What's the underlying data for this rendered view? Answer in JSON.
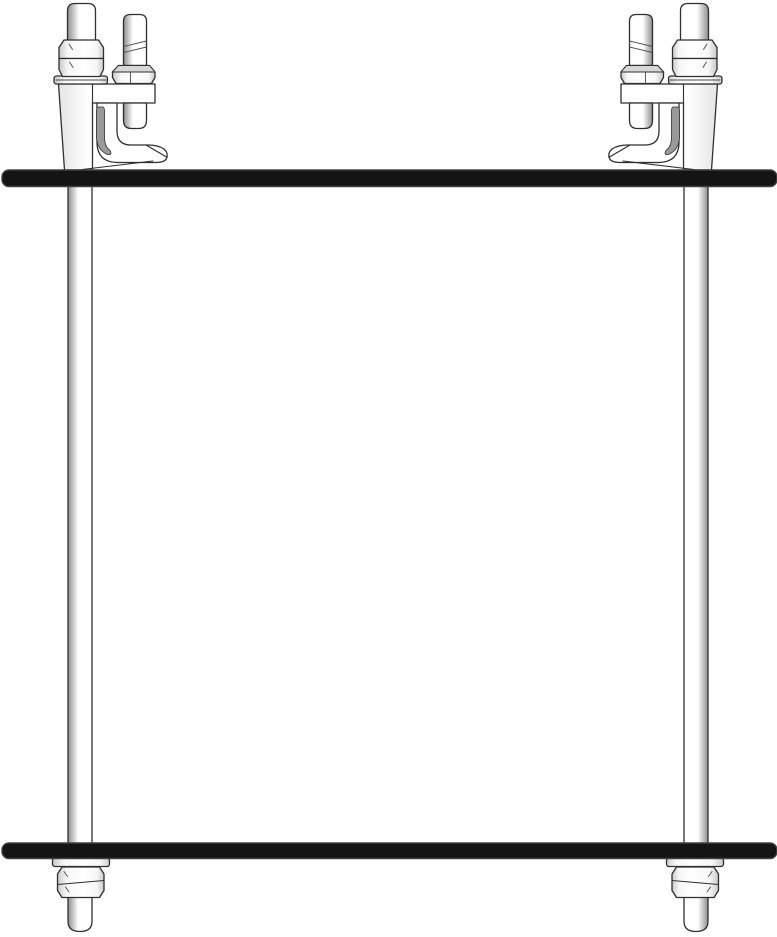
{
  "figure": {
    "type": "technical-line-drawing",
    "subject": "beam-clamp-trapeze-hanger-assembly",
    "components": {
      "beams": [
        "top-beam-flange",
        "bottom-beam-flange"
      ],
      "hangers": [
        "hanger-assembly-left",
        "hanger-assembly-right"
      ],
      "hanger_parts": [
        "threaded-rod",
        "rod-top-stub",
        "top-hex-nut",
        "top-jam-nut",
        "top-washer",
        "beam-clamp-body",
        "clamp-jaw-hook",
        "set-bolt-shaft",
        "set-bolt-hex-nut",
        "set-bolt-tip",
        "bottom-washer",
        "bottom-double-hex-nut",
        "rod-bottom-end"
      ],
      "right_hanger_note": "mirror-of-left"
    }
  },
  "colors": {
    "background": "#ffffff",
    "outline": "#2f2f2f",
    "beam_fill": "#141417",
    "beam_edge": "#3f3f3f",
    "part_fill": "#ffffff",
    "rod_shade": "#8e8e8e",
    "nut_shade": "#c9c9c9",
    "nut_light": "#f7f7f7",
    "nut_face": "#d7d7d7",
    "body_shade": "#e4e4e4",
    "hook_shade": "#9a9a9a"
  }
}
